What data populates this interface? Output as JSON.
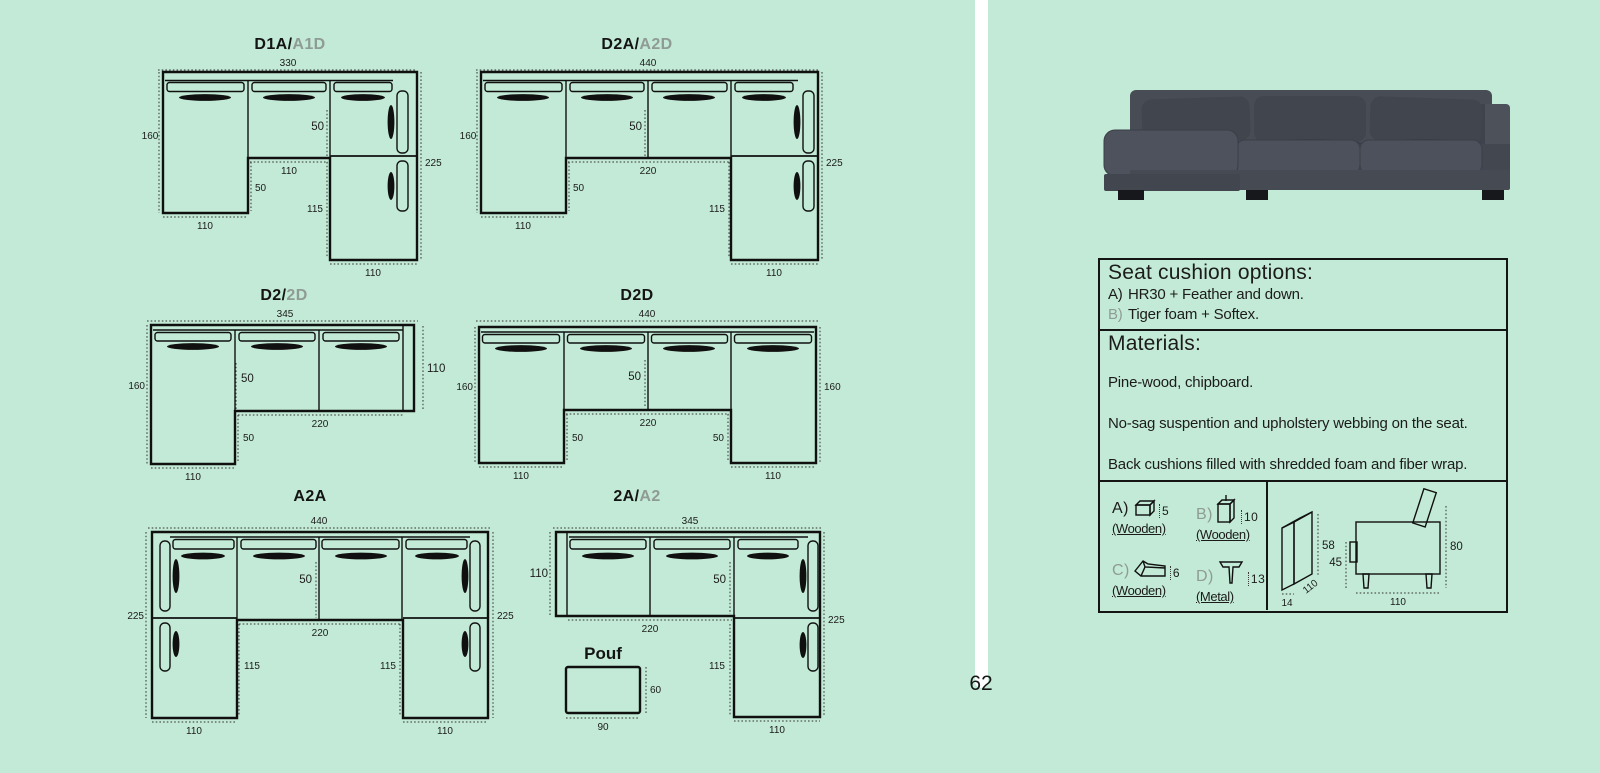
{
  "page": {
    "number": "62"
  },
  "colors": {
    "background": "#c3ead6",
    "ink": "#141414",
    "muted": "#8f9b95",
    "sofa_body": "#4a4f58",
    "divider": "#ffffff"
  },
  "diagrams": {
    "d1a": {
      "title_main": "D1A/",
      "title_alt": "A1D",
      "dim_top": "330",
      "dim_left": "160",
      "dim_seat": "50",
      "dim_mid": "110",
      "dim_mid_drop": "50",
      "dim_bottom_left": "110",
      "dim_right_inner": "115",
      "dim_right": "225",
      "dim_bottom_right": "110"
    },
    "d2a": {
      "title_main": "D2A/",
      "title_alt": "A2D",
      "dim_top": "440",
      "dim_left": "160",
      "dim_seat": "50",
      "dim_mid": "220",
      "dim_mid_drop": "50",
      "dim_bottom_left": "110",
      "dim_right_inner": "115",
      "dim_right": "225",
      "dim_bottom_right": "110"
    },
    "d2": {
      "title_main": "D2/",
      "title_alt": "2D",
      "dim_top": "345",
      "dim_left": "160",
      "dim_seat": "50",
      "dim_mid": "220",
      "dim_mid_drop": "50",
      "dim_bottom_left": "110",
      "dim_right": "110"
    },
    "d2d": {
      "title_main": "D2D",
      "title_alt": "",
      "dim_top": "440",
      "dim_left": "160",
      "dim_seat": "50",
      "dim_mid": "220",
      "dim_left_drop": "50",
      "dim_right_drop": "50",
      "dim_bottom_left": "110",
      "dim_bottom_right": "110",
      "dim_right": "160"
    },
    "a2a": {
      "title_main": "A2A",
      "title_alt": "",
      "dim_top": "440",
      "dim_left": "225",
      "dim_seat": "50",
      "dim_mid": "220",
      "dim_left_inner": "115",
      "dim_right_inner": "115",
      "dim_bottom_left": "110",
      "dim_bottom_right": "110",
      "dim_right": "225"
    },
    "a2": {
      "title_main": "2A/",
      "title_alt": "A2",
      "dim_top": "345",
      "dim_left": "110",
      "dim_seat": "50",
      "dim_mid": "220",
      "dim_right_inner": "115",
      "dim_right": "225",
      "dim_bottom_right": "110"
    },
    "pouf": {
      "title": "Pouf",
      "dim_width": "90",
      "dim_height": "60"
    }
  },
  "info": {
    "cushions": {
      "title": "Seat cushion options:",
      "options": [
        {
          "label": "A)",
          "text": "HR30 + Feather and down."
        },
        {
          "label": "B)",
          "text": "Tiger foam + Softex."
        }
      ]
    },
    "materials": {
      "title": "Materials:",
      "lines": [
        "Pine-wood, chipboard.",
        "No-sag suspention and upholstery webbing on the seat.",
        "Back cushions filled with shredded foam and fiber wrap."
      ]
    },
    "legs": {
      "items": [
        {
          "label": "A)",
          "height": "5",
          "material": "(Wooden)"
        },
        {
          "label": "B)",
          "height": "10",
          "material": "(Wooden)"
        },
        {
          "label": "C)",
          "height": "6",
          "material": "(Wooden)"
        },
        {
          "label": "D)",
          "height": "13",
          "material": "(Metal)"
        }
      ]
    },
    "cushion_box": {
      "height": "58",
      "thickness": "14",
      "width": "110"
    },
    "side_view": {
      "back_height": "80",
      "seat_height": "45",
      "depth": "110"
    }
  }
}
